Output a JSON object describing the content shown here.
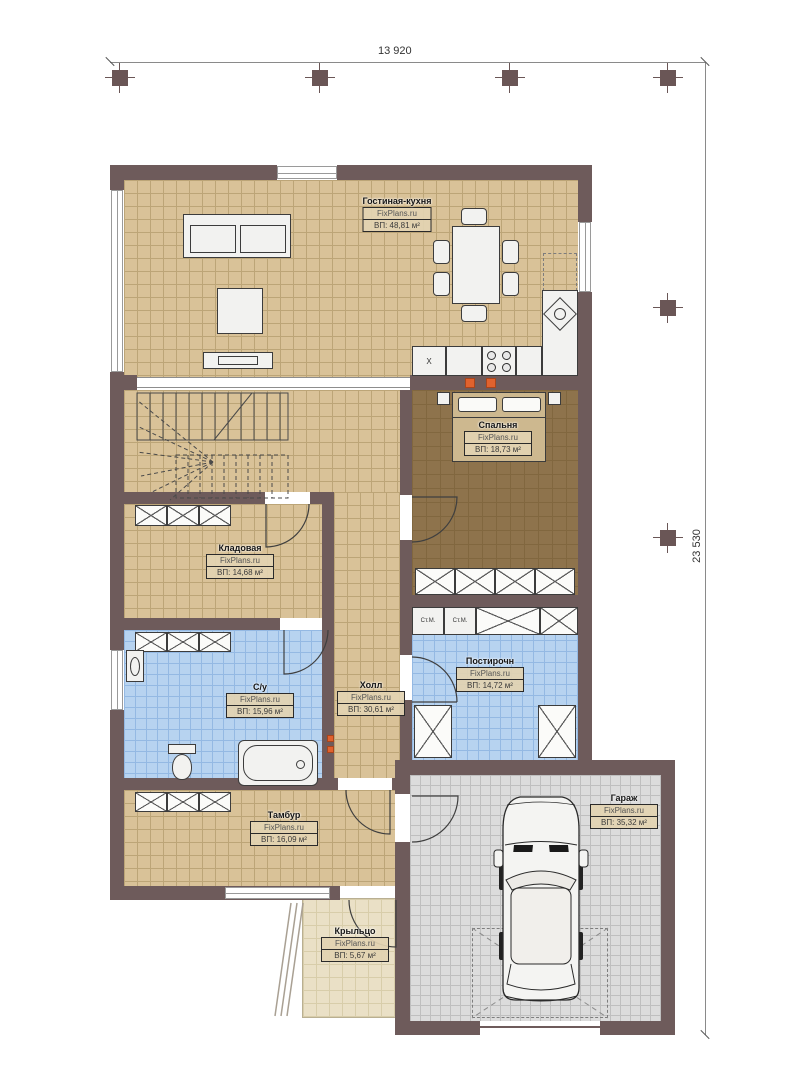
{
  "dimensions": {
    "width_label": "13 920",
    "height_label": "23 530"
  },
  "watermark": "FixPlans.ru",
  "rooms": {
    "living": {
      "name": "Гостиная-кухня",
      "brand": "FixPlans.ru",
      "area": "ВП: 48,81 м²"
    },
    "bedroom": {
      "name": "Спальня",
      "brand": "FixPlans.ru",
      "area": "ВП: 18,73 м²"
    },
    "storage": {
      "name": "Кладовая",
      "brand": "FixPlans.ru",
      "area": "ВП: 14,68 м²"
    },
    "bath": {
      "name": "С/у",
      "brand": "FixPlans.ru",
      "area": "ВП: 15,96 м²"
    },
    "hall": {
      "name": "Холл",
      "brand": "FixPlans.ru",
      "area": "ВП: 30,61 м²"
    },
    "laundry": {
      "name": "Постирочн",
      "brand": "FixPlans.ru",
      "area": "ВП: 14,72 м²"
    },
    "tambur": {
      "name": "Тамбур",
      "brand": "FixPlans.ru",
      "area": "ВП: 16,09 м²"
    },
    "porch": {
      "name": "Крыльцо",
      "brand": "FixPlans.ru",
      "area": "ВП: 5,67 м²"
    },
    "garage": {
      "name": "Гараж",
      "brand": "FixPlans.ru",
      "area": "ВП: 35,32 м²"
    }
  },
  "appliances": {
    "washer_label": "Ст.М.",
    "fridge_label": "Х"
  },
  "colors": {
    "wall": "#6e5b5b",
    "floor_tan": "#d9c298",
    "floor_bedroom": "#8e734c",
    "floor_tile_blue": "#b7d3f0",
    "floor_garage": "#dcdcdc",
    "floor_porch": "#eae0c6",
    "accent_orange": "#e0622e"
  }
}
